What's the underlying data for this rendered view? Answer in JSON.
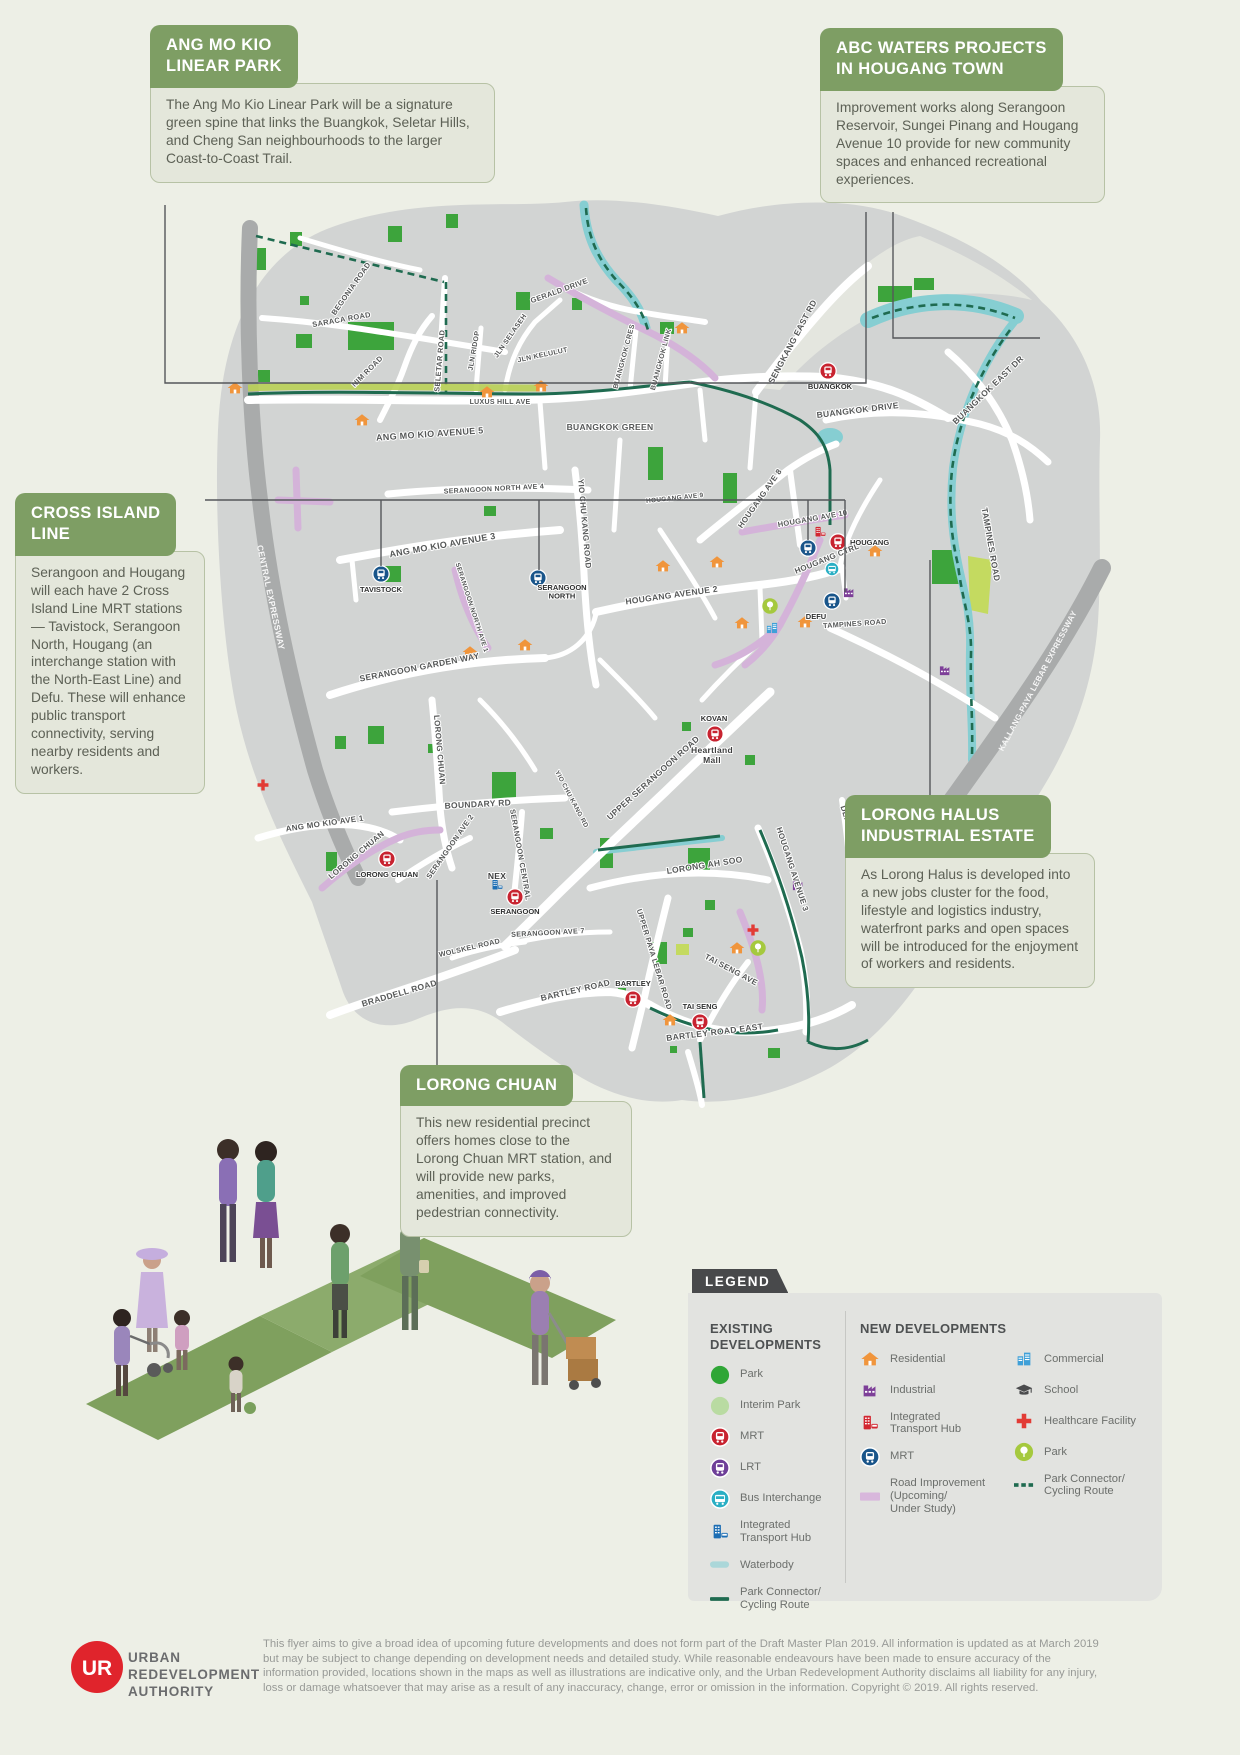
{
  "colors": {
    "page_bg": "#edefe6",
    "callout_green": "#7e9e64",
    "callout_body": "#e4e7db",
    "land": "#d2d4d3",
    "road_white": "#ffffff",
    "expressway": "#a9abab",
    "park_green": "#3da43c",
    "interim_park": "#b9dba2",
    "water": "#86ced2",
    "road_improvement": "#d4b3d9",
    "park_connector": "#1f6b50",
    "mrt_red": "#c82330",
    "mrt_new_blue": "#19558a",
    "lrt_purple": "#6e3f98",
    "bus_teal": "#2aafc4",
    "ith_blue": "#1c6eb4",
    "ith_new_red": "#d22630",
    "residential_orange": "#f0953c",
    "industrial_purple": "#7d3f98",
    "commercial_blue": "#3fa0d8",
    "healthcare_red": "#e23b35",
    "park_new_lime": "#a5c93e",
    "school_gray": "#4a4b4d",
    "legend_tab": "#48494b",
    "ura_red": "#e0242c"
  },
  "callouts": {
    "amk": {
      "title": "ANG MO KIO\nLINEAR PARK",
      "body": "The Ang Mo Kio Linear Park will be a signature green spine that links the Buangkok, Seletar Hills, and Cheng San neighbourhoods to the larger Coast-to-Coast Trail."
    },
    "abc": {
      "title": "ABC WATERS PROJECTS\nIN HOUGANG TOWN",
      "body": "Improvement works along Serangoon Reservoir, Sungei Pinang and Hougang Avenue 10 provide for new community spaces and enhanced recreational experiences."
    },
    "cil": {
      "title": "CROSS ISLAND\nLINE",
      "body": "Serangoon and Hougang will each have 2 Cross Island Line MRT stations — Tavistock, Serangoon North, Hougang (an interchange station with the North-East Line) and Defu. These will enhance public transport connectivity, serving nearby residents and workers."
    },
    "halus": {
      "title": "LORONG HALUS\nINDUSTRIAL ESTATE",
      "body": "As Lorong Halus is developed into a new jobs cluster for the food, lifestyle and logistics industry, waterfront parks and open spaces will be introduced for the enjoyment of workers and residents."
    },
    "chuan": {
      "title": "LORONG CHUAN",
      "body": "This new residential precinct offers homes close to the Lorong Chuan MRT station, and will provide new parks, amenities, and improved pedestrian connectivity."
    }
  },
  "legend": {
    "title": "LEGEND",
    "existing": {
      "heading": "EXISTING\nDEVELOPMENTS",
      "items": [
        {
          "icon": "park",
          "label": "Park"
        },
        {
          "icon": "interim-park",
          "label": "Interim Park"
        },
        {
          "icon": "mrt",
          "label": "MRT"
        },
        {
          "icon": "lrt",
          "label": "LRT"
        },
        {
          "icon": "bus",
          "label": "Bus Interchange"
        },
        {
          "icon": "ith",
          "label": "Integrated\nTransport Hub"
        },
        {
          "icon": "waterbody",
          "label": "Waterbody"
        },
        {
          "icon": "connector",
          "label": "Park Connector/\nCycling Route"
        }
      ]
    },
    "newdev": {
      "heading": "NEW DEVELOPMENTS",
      "col1": [
        {
          "icon": "residential",
          "label": "Residential"
        },
        {
          "icon": "industrial",
          "label": "Industrial"
        },
        {
          "icon": "ith-new",
          "label": "Integrated\nTransport Hub"
        },
        {
          "icon": "mrt-new",
          "label": "MRT"
        },
        {
          "icon": "road-improvement",
          "label": "Road Improvement\n(Upcoming/\nUnder Study)"
        }
      ],
      "col2": [
        {
          "icon": "commercial",
          "label": "Commercial"
        },
        {
          "icon": "school",
          "label": "School"
        },
        {
          "icon": "healthcare",
          "label": "Healthcare Facility"
        },
        {
          "icon": "park-new",
          "label": "Park"
        },
        {
          "icon": "connector-dashed",
          "label": "Park Connector/\nCycling Route"
        }
      ]
    }
  },
  "map": {
    "road_labels": [
      {
        "t": "BEGONIA ROAD",
        "x": 353,
        "y": 290,
        "r": -55,
        "s": 7.5
      },
      {
        "t": "SARACA ROAD",
        "x": 342,
        "y": 322,
        "r": -10,
        "s": 7.5
      },
      {
        "t": "NIM ROAD",
        "x": 369,
        "y": 373,
        "r": -45,
        "s": 7.5
      },
      {
        "t": "SELETAR ROAD",
        "x": 442,
        "y": 361,
        "r": -85,
        "s": 7.5
      },
      {
        "t": "JLN RIDOP",
        "x": 476,
        "y": 351,
        "r": -80,
        "s": 7
      },
      {
        "t": "JLN SELASEH",
        "x": 512,
        "y": 337,
        "r": -55,
        "s": 7
      },
      {
        "t": "JLN KELULUT",
        "x": 543,
        "y": 357,
        "r": -12,
        "s": 7
      },
      {
        "t": "LUXUS HILL AVE",
        "x": 500,
        "y": 404,
        "r": 0,
        "s": 7
      },
      {
        "t": "GERALD DRIVE",
        "x": 560,
        "y": 293,
        "r": -20,
        "s": 7.5
      },
      {
        "t": "BUANGKOK CRES",
        "x": 626,
        "y": 357,
        "r": -75,
        "s": 7
      },
      {
        "t": "BUANGKOK LINK",
        "x": 663,
        "y": 360,
        "r": -75,
        "s": 7
      },
      {
        "t": "SENGKANG EAST RD",
        "x": 795,
        "y": 343,
        "r": -62,
        "s": 8.5
      },
      {
        "t": "BUANGKOK DRIVE",
        "x": 858,
        "y": 413,
        "r": -7,
        "s": 8.5
      },
      {
        "t": "BUANGKOK EAST DR",
        "x": 990,
        "y": 392,
        "r": -44,
        "s": 8.5
      },
      {
        "t": "BUANGKOK GREEN",
        "x": 610,
        "y": 430,
        "r": 0,
        "s": 8.5
      },
      {
        "t": "ANG MO KIO AVENUE 5",
        "x": 430,
        "y": 437,
        "r": -4,
        "s": 9
      },
      {
        "t": "SERANGOON NORTH AVE 4",
        "x": 494,
        "y": 491,
        "r": -3,
        "s": 7
      },
      {
        "t": "HOUGANG AVE 9",
        "x": 675,
        "y": 500,
        "r": -6,
        "s": 6.5
      },
      {
        "t": "HOUGANG AVE 8",
        "x": 762,
        "y": 500,
        "r": -55,
        "s": 8
      },
      {
        "t": "ANG MO KIO AVENUE 3",
        "x": 443,
        "y": 548,
        "r": -10,
        "s": 9
      },
      {
        "t": "YIO CHU KANG ROAD",
        "x": 582,
        "y": 524,
        "r": 85,
        "s": 8
      },
      {
        "t": "SERANGOON NORTH AVE 1",
        "x": 470,
        "y": 608,
        "r": 72,
        "s": 6.5
      },
      {
        "t": "HOUGANG AVE 10",
        "x": 813,
        "y": 521,
        "r": -10,
        "s": 7.5
      },
      {
        "t": "HOUGANG CTRL",
        "x": 828,
        "y": 561,
        "r": -22,
        "s": 8
      },
      {
        "t": "CENTRAL EXPRESSWAY",
        "x": 268,
        "y": 598,
        "r": 78,
        "s": 8.5,
        "w": 1
      },
      {
        "t": "TAMPINES ROAD",
        "x": 988,
        "y": 545,
        "r": 80,
        "s": 8.5
      },
      {
        "t": "HOUGANG AVENUE 2",
        "x": 672,
        "y": 598,
        "r": -8,
        "s": 8.5
      },
      {
        "t": "TAMPINES ROAD",
        "x": 855,
        "y": 626,
        "r": -4,
        "s": 7.2
      },
      {
        "t": "SERANGOON GARDEN WAY",
        "x": 420,
        "y": 670,
        "r": -11,
        "s": 8.5
      },
      {
        "t": "Heartland\nMall",
        "x": 712,
        "y": 753,
        "r": 0,
        "s": 8.5,
        "poi": 1
      },
      {
        "t": "NEX",
        "x": 497,
        "y": 879,
        "r": 0,
        "s": 8.5,
        "poi": 1
      },
      {
        "t": "LORONG CHUAN",
        "x": 437,
        "y": 750,
        "r": 85,
        "s": 8
      },
      {
        "t": "UPPER SERANGOON ROAD",
        "x": 655,
        "y": 780,
        "r": -42,
        "s": 8.5
      },
      {
        "t": "BOUNDARY RD",
        "x": 478,
        "y": 807,
        "r": -3,
        "s": 8.5
      },
      {
        "t": "ANG MO KIO AVE 1",
        "x": 325,
        "y": 826,
        "r": -8,
        "s": 8
      },
      {
        "t": "SERANGOON CENTRAL",
        "x": 518,
        "y": 855,
        "r": 80,
        "s": 7.5
      },
      {
        "t": "YIO CHU KANG RD",
        "x": 570,
        "y": 800,
        "r": 62,
        "s": 6.5
      },
      {
        "t": "LORONG CHUAN",
        "x": 358,
        "y": 857,
        "r": -40,
        "s": 8
      },
      {
        "t": "SERANGOON AVE 2",
        "x": 452,
        "y": 848,
        "r": -55,
        "s": 7.5
      },
      {
        "t": "LORONG AH SOO",
        "x": 705,
        "y": 868,
        "r": -9,
        "s": 8.5
      },
      {
        "t": "HOUGANG AVENUE 3",
        "x": 790,
        "y": 870,
        "r": 72,
        "s": 8
      },
      {
        "t": "DEFU AVE 1",
        "x": 848,
        "y": 830,
        "r": 72,
        "s": 8
      },
      {
        "t": "KALLANG-PAYA LEBAR EXPRESSWAY",
        "x": 1040,
        "y": 682,
        "r": -62,
        "s": 8,
        "w": 1
      },
      {
        "t": "SERANGOON AVE 7",
        "x": 548,
        "y": 935,
        "r": -3,
        "s": 7.2
      },
      {
        "t": "WOLSKEL ROAD",
        "x": 470,
        "y": 950,
        "r": -13,
        "s": 7.2
      },
      {
        "t": "BRADDELL ROAD",
        "x": 400,
        "y": 996,
        "r": -16,
        "s": 8.5
      },
      {
        "t": "BARTLEY ROAD",
        "x": 576,
        "y": 993,
        "r": -13,
        "s": 8.5
      },
      {
        "t": "UPPER PAYA LEBAR ROAD",
        "x": 652,
        "y": 960,
        "r": 73,
        "s": 7.5
      },
      {
        "t": "BARTLEY ROAD EAST",
        "x": 715,
        "y": 1035,
        "r": -7,
        "s": 8.5
      },
      {
        "t": "TAI SENG AVE",
        "x": 730,
        "y": 972,
        "r": 28,
        "s": 8
      }
    ],
    "stations": [
      {
        "name": "Buangkok",
        "type": "mrt",
        "x": 828,
        "y": 371,
        "label": "BUANGKOK",
        "lx": 830,
        "ly": 389,
        "anchor": "middle"
      },
      {
        "name": "Hougang",
        "type": "mrt",
        "x": 838,
        "y": 542,
        "label": "HOUGANG",
        "lx": 850,
        "ly": 545,
        "anchor": "start"
      },
      {
        "name": "Hougang CRL",
        "type": "mrt-new",
        "x": 808,
        "y": 548
      },
      {
        "name": "Hougang ITH",
        "type": "ith-new",
        "x": 820,
        "y": 532
      },
      {
        "name": "Hougang Bus Interchange",
        "type": "bus",
        "x": 832,
        "y": 569
      },
      {
        "name": "Tavistock",
        "type": "mrt-new",
        "x": 381,
        "y": 574,
        "label": "TAVISTOCK",
        "lx": 381,
        "ly": 592,
        "anchor": "middle"
      },
      {
        "name": "Serangoon North",
        "type": "mrt-new",
        "x": 538,
        "y": 578,
        "label": "SERANGOON\nNORTH",
        "lx": 562,
        "ly": 590,
        "anchor": "middle"
      },
      {
        "name": "Defu",
        "type": "mrt-new",
        "x": 832,
        "y": 601,
        "label": "DEFU",
        "lx": 816,
        "ly": 619,
        "anchor": "middle"
      },
      {
        "name": "Kovan",
        "type": "mrt",
        "x": 715,
        "y": 734,
        "label": "KOVAN",
        "lx": 714,
        "ly": 721,
        "anchor": "middle"
      },
      {
        "name": "Lorong Chuan",
        "type": "mrt",
        "x": 387,
        "y": 859,
        "label": "LORONG CHUAN",
        "lx": 387,
        "ly": 877,
        "anchor": "middle"
      },
      {
        "name": "Serangoon",
        "type": "mrt",
        "x": 515,
        "y": 897,
        "label": "SERANGOON",
        "lx": 515,
        "ly": 914,
        "anchor": "middle"
      },
      {
        "name": "Serangoon ITH",
        "type": "ith",
        "x": 497,
        "y": 885
      },
      {
        "name": "Bartley",
        "type": "mrt",
        "x": 633,
        "y": 999,
        "label": "BARTLEY",
        "lx": 633,
        "ly": 986,
        "anchor": "middle"
      },
      {
        "name": "Tai Seng",
        "type": "mrt",
        "x": 700,
        "y": 1022,
        "label": "TAI SENG",
        "lx": 700,
        "ly": 1009,
        "anchor": "middle"
      }
    ],
    "markers": [
      {
        "type": "residential",
        "x": 235,
        "y": 388
      },
      {
        "type": "residential",
        "x": 362,
        "y": 420
      },
      {
        "type": "residential",
        "x": 487,
        "y": 392
      },
      {
        "type": "residential",
        "x": 541,
        "y": 386
      },
      {
        "type": "residential",
        "x": 682,
        "y": 328
      },
      {
        "type": "residential",
        "x": 470,
        "y": 652
      },
      {
        "type": "residential",
        "x": 525,
        "y": 645
      },
      {
        "type": "residential",
        "x": 663,
        "y": 566
      },
      {
        "type": "residential",
        "x": 717,
        "y": 562
      },
      {
        "type": "residential",
        "x": 742,
        "y": 623
      },
      {
        "type": "residential",
        "x": 805,
        "y": 622
      },
      {
        "type": "residential",
        "x": 875,
        "y": 551
      },
      {
        "type": "residential",
        "x": 737,
        "y": 948
      },
      {
        "type": "residential",
        "x": 670,
        "y": 1020
      },
      {
        "type": "industrial",
        "x": 849,
        "y": 592
      },
      {
        "type": "industrial",
        "x": 798,
        "y": 885
      },
      {
        "type": "industrial",
        "x": 945,
        "y": 670
      },
      {
        "type": "healthcare",
        "x": 263,
        "y": 785
      },
      {
        "type": "healthcare",
        "x": 753,
        "y": 930
      },
      {
        "type": "park-new",
        "x": 770,
        "y": 606
      },
      {
        "type": "park-new",
        "x": 758,
        "y": 948
      },
      {
        "type": "commercial",
        "x": 772,
        "y": 628
      }
    ]
  },
  "footer": {
    "org": "URBAN\nREDEVELOPMENT\nAUTHORITY",
    "disclaimer": "This flyer aims to give a broad idea of upcoming future developments and does not form part of the Draft Master Plan 2019. All information is updated as at March 2019 but may be subject to change depending on development needs and detailed study. While reasonable endeavours have been made to ensure accuracy of the information provided, locations shown in the maps as well as illustrations are indicative only, and the Urban Redevelopment Authority disclaims all liability for any injury, loss or damage whatsoever that may arise as a result of any inaccuracy, change, error or omission in the information. Copyright © 2019. All rights reserved."
  }
}
